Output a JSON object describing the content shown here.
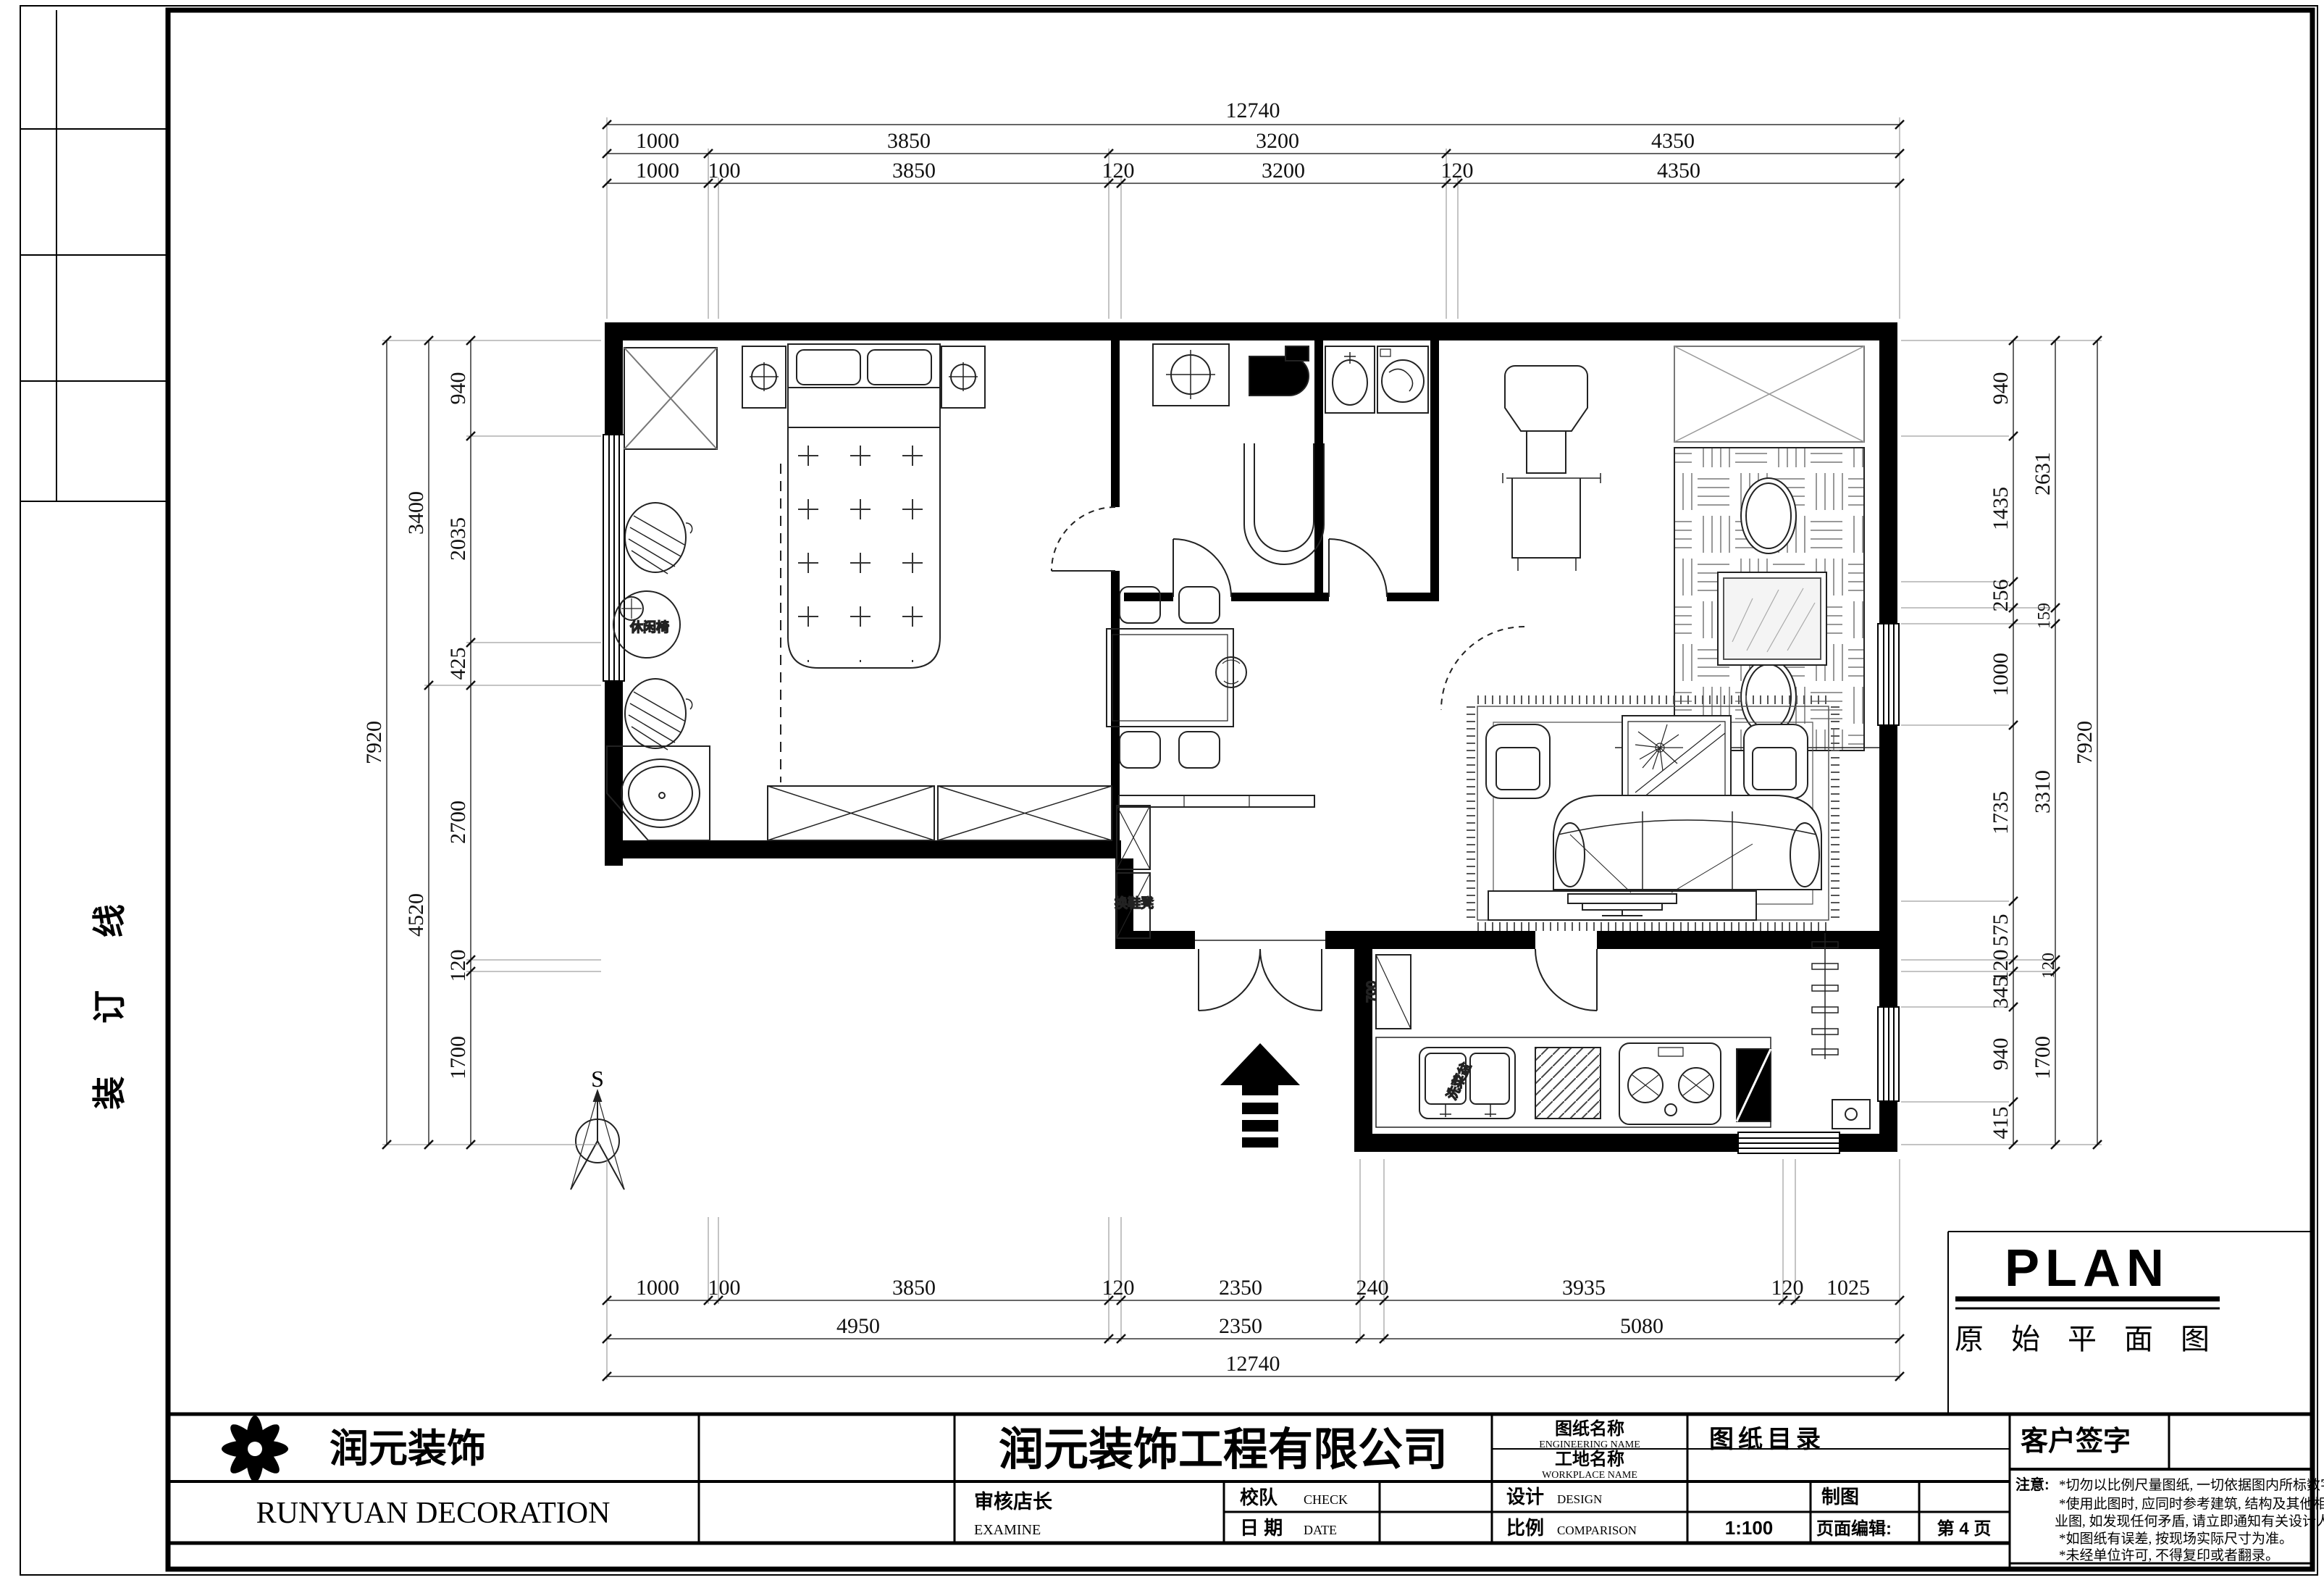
{
  "frame": {
    "binding_text": "装 订 线"
  },
  "plan_label": {
    "title_en": "PLAN",
    "title_zh": "原 始 平 面 图"
  },
  "compass": {
    "label": "S"
  },
  "room_labels": {
    "leisure_chair": "休闲椅",
    "shoe_stool": "换鞋凳",
    "sink": "洗菜盆",
    "cabinet_depth": "700"
  },
  "dimensions": {
    "top": {
      "overall": "12740",
      "row_mid": [
        "1000",
        "3850",
        "3200",
        "4350"
      ],
      "row_inner": [
        "1000",
        "100",
        "3850",
        "120",
        "3200",
        "120",
        "4350"
      ]
    },
    "bottom": {
      "row_inner": [
        "1000",
        "100",
        "3850",
        "120",
        "2350",
        "240",
        "3935",
        "120",
        "1025"
      ],
      "row_mid": [
        "4950",
        "2350",
        "5080"
      ],
      "overall": "12740"
    },
    "left": {
      "row_inner": [
        "940",
        "2035",
        "425",
        "2700",
        "120",
        "1700"
      ],
      "row_mid": [
        "3400",
        "4520"
      ],
      "overall": "7920"
    },
    "right": {
      "row_inner": [
        "940",
        "1435",
        "256",
        "1000",
        "1735",
        "575",
        "120",
        "345",
        "940",
        "415"
      ],
      "row_mid": [
        "2631",
        "159",
        "3310",
        "120",
        "1700"
      ],
      "overall": "7920"
    }
  },
  "title_block": {
    "company_short": "润元装饰",
    "company_en": "RUNYUAN DECORATION",
    "company_full": "润元装饰工程有限公司",
    "examine_label": "审核店长",
    "examine_en": "EXAMINE",
    "check_label": "校队",
    "check_en": "CHECK",
    "date_label": "日 期",
    "date_en": "DATE",
    "drawing_name_label": "图纸名称",
    "drawing_name_en": "ENGINEERING NAME",
    "drawing_name_value": "图纸目录",
    "site_name_label": "工地名称",
    "site_name_en": "WORKPLACE NAME",
    "design_label": "设计",
    "design_en": "DESIGN",
    "draft_label": "制图",
    "scale_label": "比例",
    "scale_en": "COMPARISON",
    "scale_value": "1:100",
    "page_edit_label": "页面编辑:",
    "page_value": "第 4 页",
    "signature_label": "客户签字",
    "notes_title": "注意:",
    "notes": [
      "*切勿以比例尺量图纸, 一切依据图内所标数字为准。",
      "*使用此图时, 应同时参考建筑, 结构及其他相关专",
      "业图, 如发现任何矛盾, 请立即通知有关设计人员。",
      "*如图纸有误差, 按现场实际尺寸为准。",
      "*未经单位许可, 不得复印或者翻录。"
    ]
  }
}
